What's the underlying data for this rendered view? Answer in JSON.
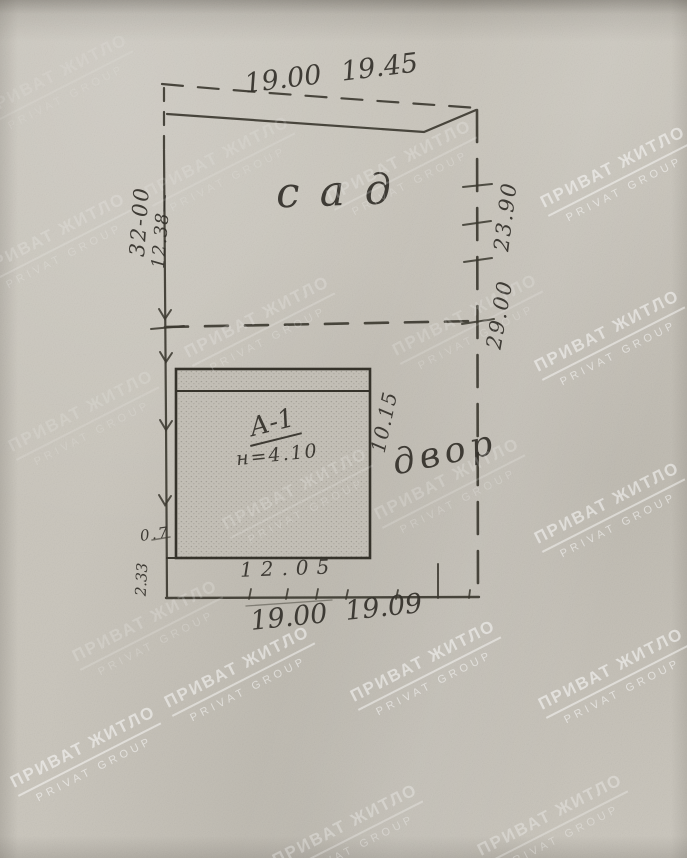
{
  "document": {
    "kind": "scanned hand-drawn land plot plan"
  },
  "plan": {
    "areas": {
      "garden": "сад",
      "yard": "двор"
    },
    "building": {
      "label": "А-1",
      "note": "н=4.10"
    },
    "dimensions": {
      "top_old": "19.00",
      "top_new": "19.45",
      "left_total": "32-00",
      "left_part": "12.38—",
      "right_upper": "23.90",
      "right_lower": "29.00",
      "building_side": "10.15",
      "building_front": "12.05",
      "bottom_old": "19.00",
      "bottom_new": "19.09",
      "step_width": "0.7",
      "step_depth": "2.33"
    }
  },
  "watermark": {
    "line1": "ПРИВАТ ЖИТЛО",
    "line2": "PRIVAT GROUP"
  },
  "colors": {
    "paper": "#cbc7be",
    "ink": "#3b382f",
    "building_fill": "#c6c2b9",
    "watermark": "#ffffff"
  }
}
